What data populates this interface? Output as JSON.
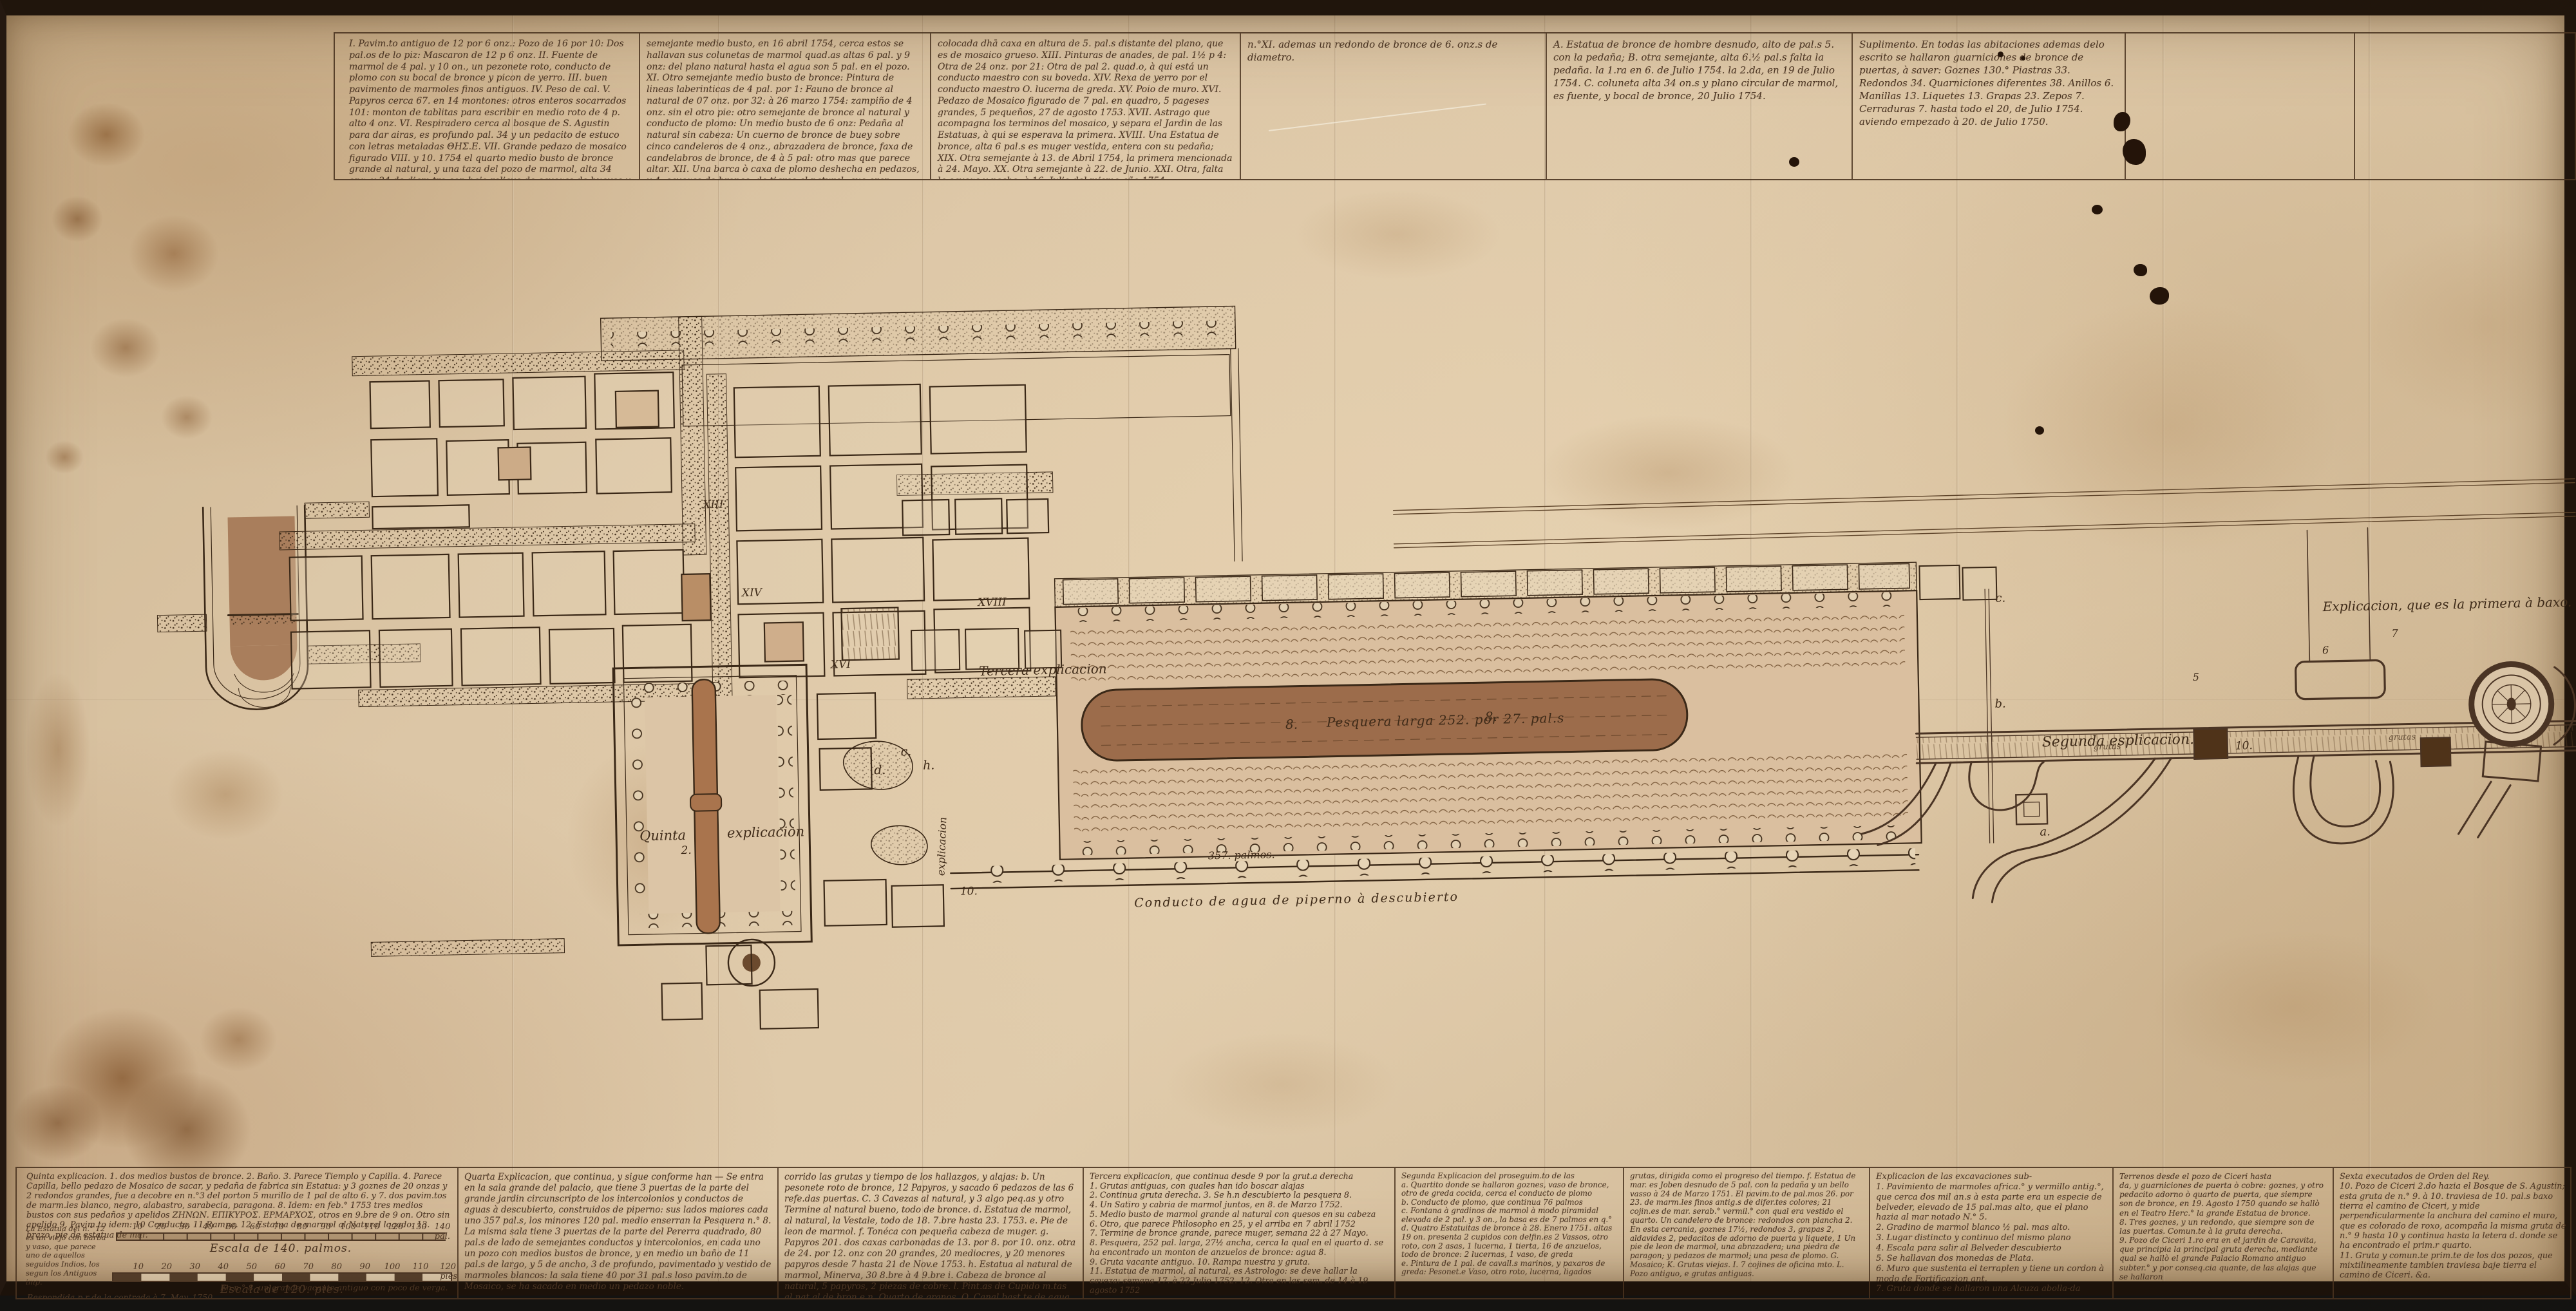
{
  "palette": {
    "parchment": "#dcc6a6",
    "ink": "#4b3523",
    "frame": "#20150c",
    "pool_wash": "#9c6c4b",
    "brown_wash": "#a97e5c"
  },
  "top": {
    "c1": "I. Pavim.to antiguo de 12 por 6 onz.: Pozo de 16 por 10: Dos pal.os de lo piz: Mascaron de 12 p 6 onz. II. Fuente de marmol de 4 pal. y 10 on., un pezonete roto, conducto de plomo con su bocal de bronce y picon de yerro. III. buen pavimento de marmoles finos antiguos. IV. Peso de cal. V. Papyros cerca 67. en 14 montones: otros enteros socarrados 101: monton de tablitas para escribir en medio roto de 4 p. alto 4 onz. VI. Respiradero cerca al bosque de S. Agustin para dar airas, es profundo pal. 34 y un pedacito de estuco con letras metaladas ΘΗΣ.Ε. VII. Grande pedazo de mosaico figurado VIII. y 10. 1754 el quarto medio busto de bronce grande al natural, y una taza del pozo de marmol, alta 34 onz. y 24 de diam.tro con bajo relieve de cavezas de bueyes y flores. IX. otro semejante medio busto a 10 abril 1754: vaso roto de bronce, conducto de plomo. X. Otro",
    "c2": "semejante medio busto, en 16 abril 1754, cerca estos se hallavan sus colunetas de marmol quad.as altas 6 pal. y 9 onz: del plano natural hasta el agua son 5 pal. en el pozo. XI. Otro semejante medio busto de bronce: Pintura de lineas laberinticas de 4 pal. por 1: Fauno de bronce al natural de 07 onz. por 32: à 26 marzo 1754: zampiño de 4 onz. sin el otro pie: otro semejante de bronce al natural y conducto de plomo: Un medio busto de 6 onz: Pedaña al natural sin cabeza: Un cuerno de bronce de buey sobre cinco candeleros de 4 onz., abrazadera de bronce, faxa de candelabros de bronce, de 4 à 5 pal: otro mas que parece altar. XII. Una barca ò caxa de plomo deshecha en pedazos, y 4. cavezas de bronce, de tigres al natural, que eran encaxadas al mismo plomo, que estava en este mismo hecho",
    "c3": "colocada dhā caxa en altura de 5. pal.s distante del plano, que es de mosaico grueso. XIII. Pinturas de anades, de pal. 1½ p 4: Otra de 24 onz. por 21: Otra de pal 2. quad.o, à qui está un conducto maestro con su boveda. XIV. Rexa de yerro por el conducto maestro O. lucerna de greda. XV. Poio de muro. XVI. Pedazo de Mosaico figurado de 7 pal. en quadro, 5 pageses grandes, 5 pequeños, 27 de agosto 1753. XVII. Astrago que acompagna los terminos del mosaico, y separa el Jardin de las Estatuas, à qui se esperava la primera. XVIII. Una Estatua de bronce, alta 6 pal.s es muger vestida, entera con su pedaña; XIX. Otra semejante à 13. de Abril 1754, la primera mencionada à 24. Mayo. XX. Otra semejante à 22. de Junio. XXI. Otra, falta la caveza y pecho, à 16. Julio del mismo año 1754.",
    "nxi": "n.°XI. ademas un redondo de bronce de 6. onz.s de diametro.",
    "abc": "A. Estatua de bronce de hombre desnudo, alto de pal.s 5. con la pedaña; B. otra semejante, alta 6.½ pal.s falta la pedaña. la 1.ra en 6. de Julio 1754. la 2.da, en 19 de Julio 1754. C. coluneta alta 34 on.s y plano circular de marmol, es fuente, y bocal de bronce, 20 Julio 1754.",
    "supl": "Suplimento. En todas las abitaciones ademas delo escrito se hallaron guarniciones de bronce de puertas, à saver: Goznes 130.° Piastras 33. Redondos 34. Quarniciones diferentes 38. Anillos 6. Manillas 13. Liquetes 13. Grapas 23. Zepos 7. Cerraduras 7. hasta todo el 20, de Julio 1754. aviendo empezado à 20. de Julio 1750."
  },
  "plan": {
    "tercera": "Tercera explicacion",
    "quinta_l": "Quinta",
    "quinta_n": "2.",
    "quinta_r": "explicacion",
    "pesq_l": "8.",
    "pesq": "Pesquera larga 252. por 27. pal.s",
    "pesq_r": "8.",
    "conducto": "Conducto de agua de piperno à descubierto",
    "palmos357": "357. palmos.",
    "segunda": "Segunda esplicacion.",
    "primera": "Explicacion, que es la primera à baxo. 1.",
    "lit_a": "a.",
    "lit_b": "b.",
    "lit_c": "c.",
    "lit_d": "d.",
    "lit_h": "h.",
    "lit_10": "10.",
    "vert": "explicacion",
    "r13": "XIII",
    "r14": "XIV",
    "r16": "XVI",
    "r18": "XVIII",
    "n5": "5",
    "n6": "6",
    "n7": "7",
    "grutas": "grutas"
  },
  "bottom": {
    "quinta": "Quinta explicacion. 1. dos medios bustos de bronce. 2. Baño. 3. Parece Tiemplo y Capilla. 4. Parece Capilla, bello pedazo de Mosaico de sacar, y pedaña de fabrica sin Estatua: y 3 goznes de 20 onzas y 2 redondos grandes, fue a decobre en n.°3 del porton 5 murillo de 1 pal de alto 6. y 7. dos pavim.tos de marm.les blanco, negro, alabastro, sarabecia, paragona. 8. Idem: en feb.° 1753 tres medios bustos con sus pedaños y apelidos ΖΗΝΩΝ. ΕΠΙΚΥΡΟΣ. ΕΡΜΑΡΧΟΣ, otros en 9.bre de 9 on. Otro sin apelido 9. Pavim.to idem: 10 Conducto. 11 Rampa. 12. Estatua de marmol al Natural logado. 13. brazo, pie de estatua de mar.",
    "quinta_note": "La Estatua del n.° 12 es un viejo con barba y vaso, que parece uno de aquellos seguidos Indios, los segun los Antiguos imp.",
    "esc1": {
      "label": "Escala de 140. palmos.",
      "ticks": [
        "10",
        "20",
        "30",
        "40",
        "50",
        "60",
        "70",
        "80",
        "90",
        "100",
        "110",
        "120",
        "130",
        "140 pal."
      ]
    },
    "esc2": {
      "label": "Escala de 120. pies.",
      "ticks": [
        "10",
        "20",
        "30",
        "40",
        "50",
        "60",
        "70",
        "80",
        "90",
        "100",
        "110",
        "120 pies"
      ]
    },
    "quinta_f1": "Respondida p.r de la contrada à 7. May. 1750.",
    "quinta_f2": "En n.° 8. un grande vacante antiguo con poco de verga.",
    "quarta1": "Quarta Explicacion, que continua, y sigue conforme han — Se entra en la sala grande del palacio, que tiene 3 puertas de la parte del grande jardin circunscripto de los intercolonios y conductos de aguas à descubierto, construidos de piperno: sus lados maiores cada uno 357 pal.s, los minores 120 pal. medio enserran la Pesquera n.° 8. La misma sala tiene 3 puertas de la parte del Pererra quadrado, 80 pal.s de lado de semejantes conductos y intercolonios, en cada uno un pozo con medios bustos de bronce, y en medio un baño de 11 pal.s de largo, y 5 de ancho, 3 de profundo, pavimentado y vestido de marmoles blancos: la sala tiene 40 por 31 pal.s loso pavim.to de Mosaico, se ha sacado en medio un pedazo noble.",
    "quarta2": "corrido las grutas y tiempo de los hallazgos, y alajas: b. Un pesonete roto de bronce, 12 Papyros, y sacado 6 pedazos de las 6 refe.das puertas. C. 3 Cavezas al natural, y 3 algo peq.as y otro Termine al natural bueno, todo de bronce. d. Estatua de marmol, al natural, la Vestale, todo de 18. 7.bre hasta 23. 1753. e. Pie de leon de marmol. f. Tonéca con pequeña cabeza de muger. g. Papyros 201. dos caxas carbonadas de 13. por 8. por 10. onz. otra de 24. por 12. onz con 20 grandes, 20 mediocres, y 20 menores papyros desde 7 hasta 21 de Nov.e 1753. h. Estatua al natural de marmol, Minerva, 30 8.bre à 4 9.bre i. Cabeza de bronce al natural, 5 papyros, 2 piezas de cobre. l. Pint.as de Cupido m.tas al nat.al de bron.e n. Quarto de granos. O. Canal bast.te de agua.",
    "tercera": "Tercera explicacion, que continua desde 9 por la grut.a derecha\n1. Grutas antiguas, con quales han ido boscar alajas\n2. Continua gruta derecha. 3. Se h.n descubierto la pesquera 8.\n4. Un Satiro y cabria de marmol juntos, en 8. de Marzo 1752.\n5. Medio busto de marmol grande al natural con quesos en su cabeza\n6. Otro, que parece Philosopho en 25, y el arriba en 7 abril 1752\n7. Termine de bronce grande, parece muger, semana 22 à 27 Mayo.\n8. Pesquera, 252 pal. larga, 27½ ancha, cerca la qual en el quarto d. se ha encontrado un monton de anzuelos de bronce: agua 8.\n9. Gruta vacante antiguo. 10. Rampa nuestra y gruta.\n11. Estatua de marmol, al natural, es Astrologo: se deve hallar la caveza: semana 17. à 22 Julio 1752. 12. Otra en las sem. de 14 à 19 agosto 1752",
    "segunda1": "Segunda Explicacion del proseguim.to de las\na. Quartito donde se hallaron goznes, vaso de bronce, otro de greda cocida, cerca el conducto de plomo\nb. Conducto de plomo, que continua 76 palmos\nc. Fontana à gradinos de marmol à modo piramidal elevada de 2 pal. y 3 on., la basa es de 7 palmos en q.°\nd. Quatro Estatuitas de bronce à 28. Enero 1751. altas 19 on. presenta 2 cupidos con delfin.es 2 Vassos, otro roto, con 2 asas, 1 lucerna, 1 tierta, 16 de anzuelos, todo de bronce: 2 lucernas, 1 vaso, de greda\ne. Pintura de 1 pal. de cavall.s marinos, y paxaros de greda: Pesonet.e Vaso, otro roto, lucerna, ligados",
    "segunda2": "grutas, dirigida como el progreso del tiempo. f. Estatua de mar. es Joben desnudo de 5 pal. con la pedaña y un bello vasso à 24 de Marzo 1751. El pavim.to de pal.mos 26. por 23. de marm.les finos antig.s de difer.tes colores; 21 cojin.es de mar. serab.° vermil.° con qual era vestido el quarto. Un candelero de bronce: redondos con plancha 2. En esta cercania, goznes 17½, redondos 3, grapas 2, aldavides 2, pedacitos de adorno de puerta y liquete, 1 Un pie de leon de marmol, una abrazadera; una piedra de paragon; y pedazos de marmol; una pesa de plomo. G. Mosaico; K. Grutas viejas. I. 7 cojines de oficina mto. L. Pozo antiguo, e grutas antiguas.",
    "excav": "Explicacion de las excavaciones sub-\n1. Pavimiento de marmoles africa.° y vermillo antig.°, que cerca dos mil an.s à esta parte era un especie de belveder, elevado de 15 pal.mas alto, que el plano hazia al mar notado N.° 5.\n2. Gradino de marmol blanco ½ pal. mas alto.\n3. Lugar distincto y continuo del mismo plano\n4. Escala para salir al Belveder descubierto\n5. Se hallavan dos monedas de Plata.\n6. Muro que sustenta el terraplen y tiene un cordon à modo de Fortificazion ant.\n7. Gruta donde se hallaron una Alcuza abolla-da",
    "terrenos": "Terrenos desde el pozo de Ciceri hasta\nda, y guarniciones de puerta ò cobre: goznes, y otro pedacito adorno ò quarto de puerta, que siempre son de bronce, en 19. Agosto 1750 quando se hallò en el Teatro Herc.° la grande Estatua de bronce.\n8. Tres goznes, y un redondo, que siempre son de las puertas. Comun.te à la gruta derecha.\n9. Pozo de Ciceri 1.ro era en el jardin de Caravita, que principia la principal gruta derecha, mediante qual se hallò el grande Palacio Romano antiguo subter.° y por conseq.cia quante, de las alajas que se hallaron",
    "sexta": "Sexta executados de Orden del Rey.\n10. Pozo de Ciceri 2.do hazia el Bosque de S. Agustin; esta gruta de n.° 9. à 10. traviesa de 10. pal.s baxo tierra el camino de Ciceri, y mide perpendicularmente la anchura del camino el muro, que es colorado de roxo, acompaña la misma gruta de n.° 9 hasta 10 y continua hasta la letera d. donde se ha encontrado el prim.r quarto.\n11. Gruta y comun.te prim.te de los dos pozos, que mixtilineamente tambien traviesa baje tierra el camino de Ciceri. &a."
  }
}
